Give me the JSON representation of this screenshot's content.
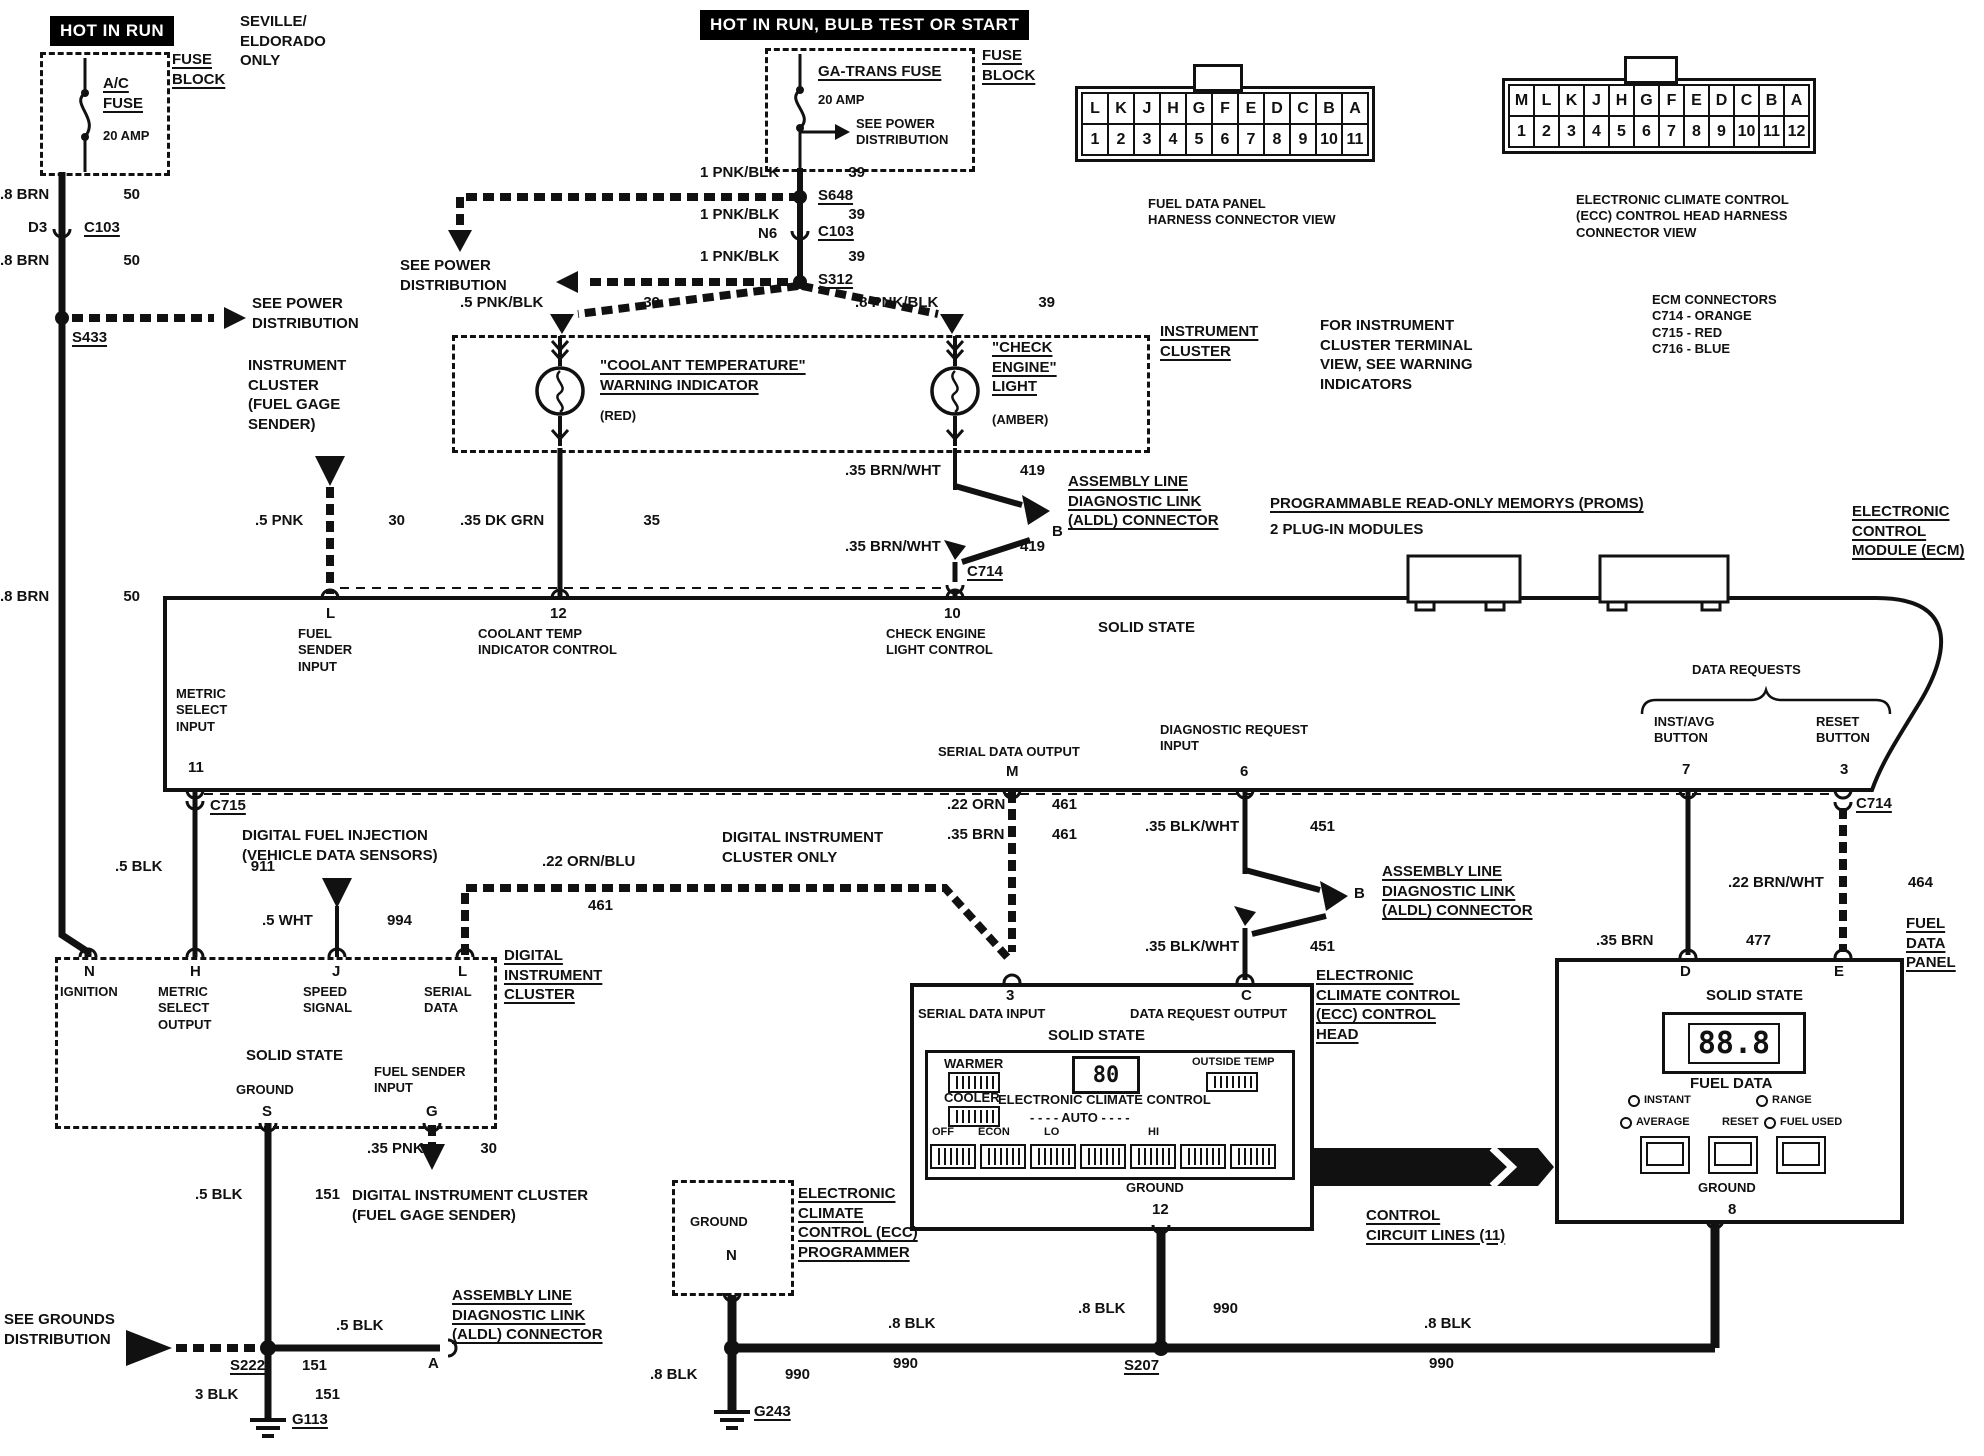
{
  "banners": {
    "hot_in_run": "HOT IN RUN",
    "hot_in_run_bulb": "HOT IN RUN, BULB TEST OR START",
    "seville": "SEVILLE/\nELDORADO\nONLY"
  },
  "fuse1": {
    "name": "A/C\nFUSE",
    "amp": "20 AMP",
    "block": "FUSE\nBLOCK"
  },
  "fuse2": {
    "name": "GA-TRANS FUSE",
    "amp": "20 AMP",
    "see_power": "SEE POWER\nDISTRIBUTION",
    "block": "FUSE\nBLOCK"
  },
  "left_rail": {
    "w1": {
      "c": ".8 BRN",
      "n": "50"
    },
    "d3": "D3",
    "c103": "C103",
    "w2": {
      "c": ".8 BRN",
      "n": "50"
    },
    "s433": "S433",
    "see_power": "SEE POWER\nDISTRIBUTION",
    "w3": {
      "c": ".8 BRN",
      "n": "50"
    }
  },
  "feed": {
    "w1": {
      "c": "1 PNK/BLK",
      "n": "39"
    },
    "s648": "S648",
    "w2": {
      "c": "1 PNK/BLK",
      "n": "39"
    },
    "n6": "N6",
    "c103": "C103",
    "w3": {
      "c": "1 PNK/BLK",
      "n": "39"
    },
    "s312": "S312",
    "see_power": "SEE POWER\nDISTRIBUTION",
    "w4": {
      "c": ".5 PNK/BLK",
      "n": "39"
    },
    "w5": {
      "c": ".8 PNK/BLK",
      "n": "39"
    }
  },
  "connector_views": {
    "fuel_data_panel": {
      "letters": [
        "L",
        "K",
        "J",
        "H",
        "G",
        "F",
        "E",
        "D",
        "C",
        "B",
        "A"
      ],
      "numbers": [
        "1",
        "2",
        "3",
        "4",
        "5",
        "6",
        "7",
        "8",
        "9",
        "10",
        "11"
      ],
      "caption": "FUEL DATA PANEL\nHARNESS CONNECTOR VIEW"
    },
    "ecc": {
      "letters": [
        "M",
        "L",
        "K",
        "J",
        "H",
        "G",
        "F",
        "E",
        "D",
        "C",
        "B",
        "A"
      ],
      "numbers": [
        "1",
        "2",
        "3",
        "4",
        "5",
        "6",
        "7",
        "8",
        "9",
        "10",
        "11",
        "12"
      ],
      "caption": "ELECTRONIC CLIMATE CONTROL\n(ECC) CONTROL HEAD HARNESS\nCONNECTOR VIEW"
    },
    "ecm_note": "ECM CONNECTORS\nC714 - ORANGE\nC715 - RED\nC716 - BLUE"
  },
  "cluster": {
    "coolant_title": "\"COOLANT TEMPERATURE\"\nWARNING INDICATOR",
    "coolant_color": "(RED)",
    "check_title": "\"CHECK\nENGINE\"\nLIGHT",
    "check_color": "(AMBER)",
    "label": "INSTRUMENT\nCLUSTER",
    "note": "FOR INSTRUMENT\nCLUSTER TERMINAL\nVIEW, SEE WARNING\nINDICATORS",
    "sender_label": "INSTRUMENT\nCLUSTER\n(FUEL GAGE\nSENDER)"
  },
  "mid_wires": {
    "pnk30": {
      "c": ".5 PNK",
      "n": "30"
    },
    "dkgrn35": {
      "c": ".35 DK GRN",
      "n": "35"
    },
    "brnwht419a": {
      "c": ".35 BRN/WHT",
      "n": "419"
    },
    "b1": "B",
    "brnwht419b": {
      "c": ".35 BRN/WHT",
      "n": "419"
    },
    "c714": "C714",
    "aldl": "ASSEMBLY LINE\nDIAGNOSTIC LINK\n(ALDL) CONNECTOR"
  },
  "ecm": {
    "proms_title": "PROGRAMMABLE READ-ONLY MEMORYS (PROMS)",
    "proms_sub": "2 PLUG-IN MODULES",
    "module_label": "ELECTRONIC\nCONTROL\nMODULE (ECM)",
    "solid_state": "SOLID STATE",
    "term_l": "L",
    "term_l_label": "FUEL\nSENDER\nINPUT",
    "term_12": "12",
    "term_12_label": "COOLANT TEMP\nINDICATOR CONTROL",
    "term_10": "10",
    "term_10_label": "CHECK ENGINE\nLIGHT CONTROL",
    "term_11_label": "METRIC\nSELECT\nINPUT",
    "term_11": "11",
    "c715": "C715",
    "term_m_label": "SERIAL DATA OUTPUT",
    "term_m": "M",
    "term_6_label": "DIAGNOSTIC REQUEST\nINPUT",
    "term_6": "6",
    "data_requests": "DATA REQUESTS",
    "term_7_label": "INST/AVG\nBUTTON",
    "term_7": "7",
    "term_3_label": "RESET\nBUTTON",
    "term_3": "3",
    "c714": "C714"
  },
  "lower_wires": {
    "blk911": {
      "c": ".5 BLK",
      "n": "911"
    },
    "dfi": "DIGITAL FUEL INJECTION\n(VEHICLE DATA SENSORS)",
    "wht994": {
      "c": ".5 WHT",
      "n": "994"
    },
    "ornblu461": {
      "c": ".22 ORN/BLU",
      "n": "461"
    },
    "dic_only": "DIGITAL INSTRUMENT\nCLUSTER ONLY",
    "orn461": {
      "c": ".22 ORN",
      "n": "461"
    },
    "brn461": {
      "c": ".35 BRN",
      "n": "461"
    },
    "blkwht451a": {
      "c": ".35 BLK/WHT",
      "n": "451"
    },
    "b2": "B",
    "blkwht451b": {
      "c": ".35 BLK/WHT",
      "n": "451"
    },
    "aldl": "ASSEMBLY LINE\nDIAGNOSTIC LINK\n(ALDL) CONNECTOR",
    "brn477": {
      "c": ".35 BRN",
      "n": "477"
    },
    "brnwht464": {
      "c": ".22 BRN/WHT",
      "n": "464"
    },
    "c714": "C714",
    "fdp_label": "FUEL\nDATA\nPANEL"
  },
  "dic": {
    "term_n": "N",
    "ignition": "IGNITION",
    "term_h": "H",
    "metric": "METRIC\nSELECT\nOUTPUT",
    "term_j": "J",
    "speed": "SPEED\nSIGNAL",
    "term_l": "L",
    "serial": "SERIAL\nDATA",
    "solid_state": "SOLID STATE",
    "ground": "GROUND",
    "term_s": "S",
    "fuel_sender": "FUEL SENDER\nINPUT",
    "term_g": "G",
    "label": "DIGITAL\nINSTRUMENT\nCLUSTER"
  },
  "ecc_head": {
    "term_3": "3",
    "serial_in": "SERIAL DATA INPUT",
    "term_c": "C",
    "data_req": "DATA REQUEST OUTPUT",
    "solid_state": "SOLID STATE",
    "warmer": "WARMER",
    "cooler": "COOLER",
    "display": "80",
    "outside_temp": "OUTSIDE TEMP",
    "title": "ELECTRONIC CLIMATE CONTROL",
    "auto_row": "- - - -  AUTO  - - - -",
    "off": "OFF",
    "econ": "ECON",
    "lo": "LO",
    "hi": "HI",
    "ground": "GROUND",
    "term_12": "12",
    "label": "ELECTRONIC\nCLIMATE CONTROL\n(ECC) CONTROL\nHEAD"
  },
  "programmer": {
    "ground": "GROUND",
    "term_n": "N",
    "label": "ELECTRONIC\nCLIMATE\nCONTROL (ECC)\nPROGRAMMER"
  },
  "control_lines": "CONTROL\nCIRCUIT LINES (11)",
  "fuel_panel": {
    "term_d": "D",
    "solid_state": "SOLID STATE",
    "term_e": "E",
    "display": "88.8",
    "title": "FUEL DATA",
    "instant": "INSTANT",
    "average": "AVERAGE",
    "range": "RANGE",
    "reset": "RESET",
    "fuel_used": "FUEL USED",
    "ground": "GROUND",
    "term_8": "8"
  },
  "grounds": {
    "blk151": {
      "c": ".5 BLK",
      "n": "151"
    },
    "pnk30": {
      "c": ".35 PNK",
      "n": "30"
    },
    "dic_sender": "DIGITAL INSTRUMENT CLUSTER\n(FUEL GAGE SENDER)",
    "see_grounds": "SEE GROUNDS\nDISTRIBUTION",
    "blk5": ".5 BLK",
    "term_a": "A",
    "aldl": "ASSEMBLY LINE\nDIAGNOSTIC LINK\n(ALDL) CONNECTOR",
    "s222": "S222",
    "n151": "151",
    "blk3": {
      "c": "3 BLK",
      "n": "151"
    },
    "g113": "G113",
    "blk990a": {
      "c": ".8 BLK",
      "n": "990"
    },
    "g243": "G243",
    "blk990b": {
      "c": ".8 BLK",
      "n": "990"
    },
    "s207": "S207",
    "blk990c": {
      "c": ".8 BLK",
      "n": "990"
    },
    "blk990d": {
      "c": ".8 BLK",
      "n": "990"
    }
  },
  "colors": {
    "ink": "#111111",
    "paper": "#ffffff"
  }
}
